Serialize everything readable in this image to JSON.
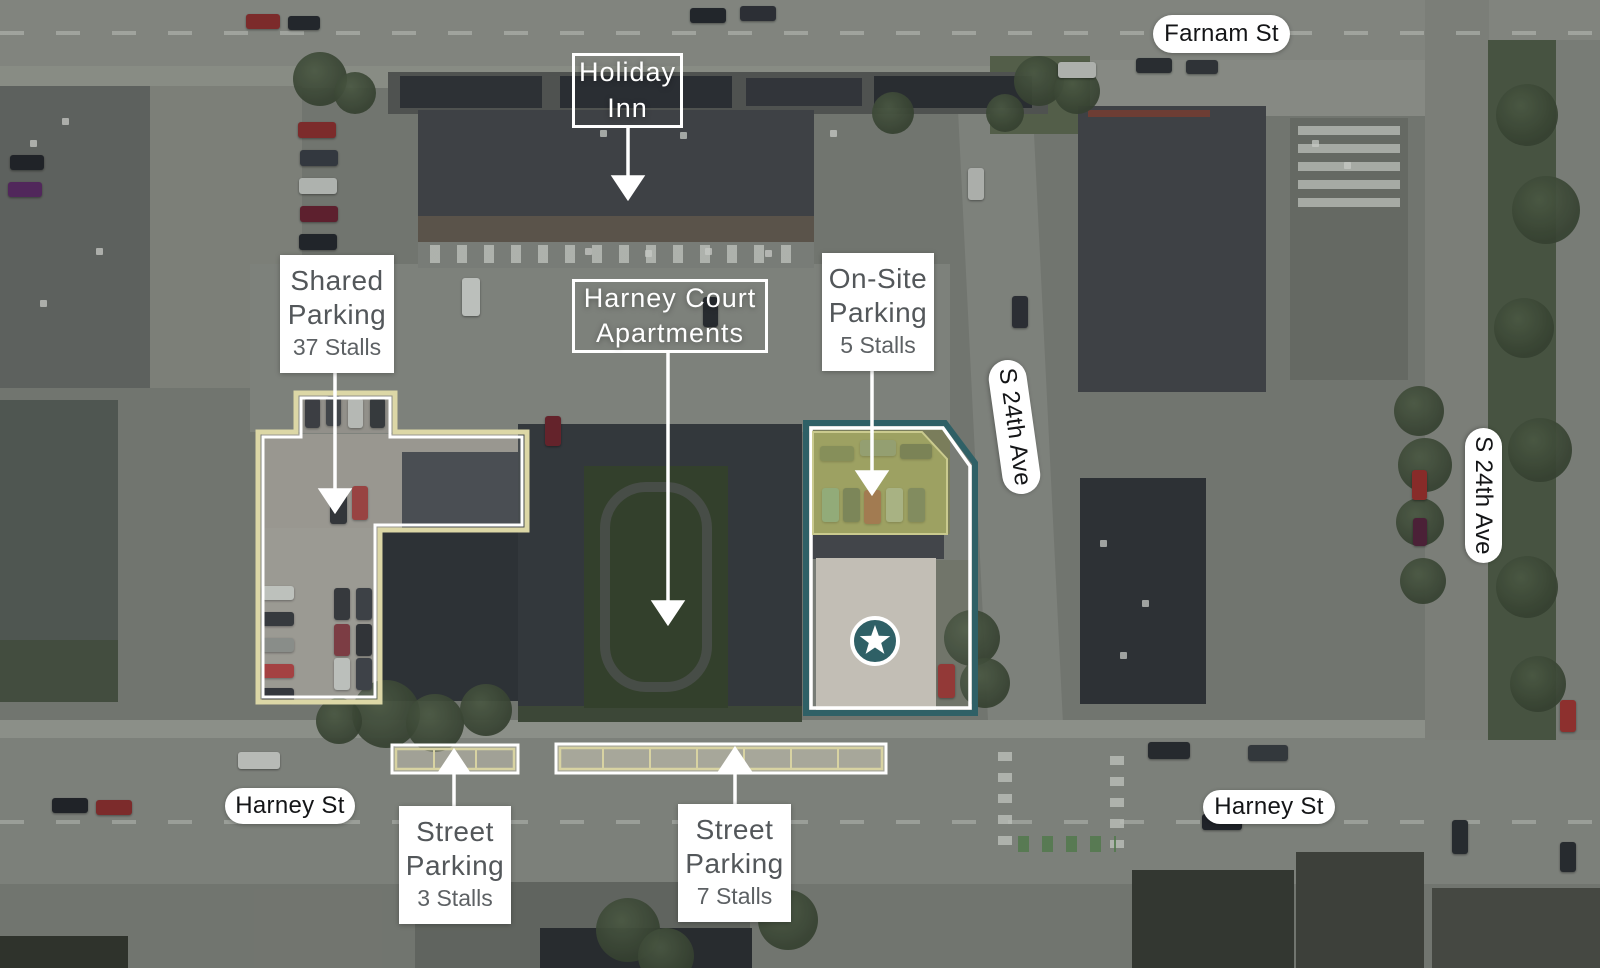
{
  "street_pills": {
    "farnam": "Farnam St",
    "harney_left": "Harney St",
    "harney_right": "Harney St",
    "s24th_center": "S 24th Ave",
    "s24th_right": "S 24th Ave"
  },
  "callouts": {
    "holiday_inn": {
      "line1": "Holiday",
      "line2": "Inn"
    },
    "harney_court": {
      "line1": "Harney Court",
      "line2": "Apartments"
    },
    "shared_parking": {
      "line1": "Shared",
      "line2": "Parking",
      "stalls": "37 Stalls"
    },
    "onsite_parking": {
      "line1": "On-Site",
      "line2": "Parking",
      "stalls": "5 Stalls"
    },
    "street_parking_west": {
      "line1": "Street",
      "line2": "Parking",
      "stalls": "3 Stalls"
    },
    "street_parking_east": {
      "line1": "Street",
      "line2": "Parking",
      "stalls": "7 Stalls"
    }
  },
  "site_marker": {
    "icon": "star-icon"
  },
  "colors": {
    "site_boundary_teal": "#2f6066",
    "parking_outline_khaki": "#dcd7a6",
    "callout_text_gray": "#53575a",
    "label_white": "#ffffff"
  }
}
